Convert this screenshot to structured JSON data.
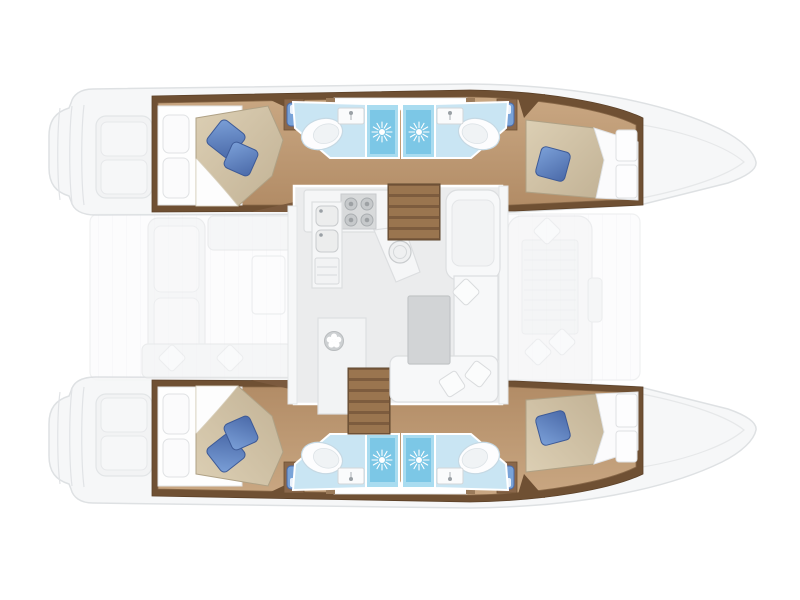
{
  "title": "Catamaran layout floor plan (top view, bow to the right)",
  "diagram_type": "boat-floor-plan",
  "labels": {
    "plan": "Catamaran layout floor plan, top view, bow to the right",
    "port_hull": "Port hull (top): aft double cabin, bathroom with toilet and washbasin, shower room, forward double cabin",
    "starboard_hull": "Starboard hull (bottom): aft double cabin, bathroom with toilet and washbasin, shower room, forward double cabin",
    "aft_cabin": "Aft double cabin with island bed and two blue cushions",
    "forward_cabin": "Forward double cabin with bed and one blue cushion",
    "bathroom_left": "Bathroom: toilet, washbasin, corner seat",
    "shower_left": "Shower cubicle with sunburst drain",
    "shower_right": "Shower cubicle with sunburst drain",
    "bathroom_right": "Bathroom: toilet, washbasin, corner seat",
    "saloon": "Saloon on bridge deck: galley and dinette",
    "galley": "Galley: four-burner stove, double sink, round sink, drawers",
    "fridge": "Refrigerator / ventilated locker",
    "table": "Dining table",
    "sofa": "L-shaped saloon sofa with cushions",
    "stairs_top": "Companionway steps to port hull",
    "stairs_bottom": "Companionway steps to starboard hull",
    "aft_cockpit": "Aft cockpit with bench seating and transom steps",
    "foredeck": "Forward cockpit sun lounger with mesh panel",
    "bow": "Bow",
    "stern_platform": "Transom swim platform with steps"
  },
  "inventory": {
    "double_cabins": 4,
    "bathrooms": 4,
    "showers": 4,
    "toilets": 4,
    "washbasins": 4,
    "blue_bed_cushions": 6,
    "corner_seats": 4,
    "companionway_stairs": 2,
    "stove_burners": 4,
    "galley_sinks": 3,
    "saloon_tables": 1,
    "sofa_cushions": 3,
    "cockpit_cushions": 2,
    "foredeck_cushions": 3
  },
  "colors": {
    "background": "#FFFFFF",
    "hull_wall_brown": "#6F5033",
    "wood_floor": "#C09C77",
    "wood_floor_light": "#C9A782",
    "wood_floor_dark": "#B28C66",
    "duvet_tan": "#D5C7AB",
    "pillow_blue": "#6C90CC",
    "pillow_blue_dark": "#42619F",
    "bathroom_floor_blue": "#C9E5F3",
    "shower_blue": "#7CC7E6",
    "shower_frame_blue": "#A9DCF0",
    "saloon_floor": "#EBECED",
    "furniture_white": "#F7F8F9",
    "furniture_outline": "#DCDEE0",
    "table_gray": "#D2D4D6",
    "stove_gray": "#D8DADB",
    "stairs_wood": "#8D6A47",
    "exterior_fill": "#F5F6F7",
    "exterior_line": "#D9DCDF"
  },
  "icons": [
    "sunburst-drain-icon",
    "fan-vent-icon",
    "stove-burner-icon",
    "faucet-icon",
    "toilet-icon",
    "diamond-cushion-icon"
  ]
}
